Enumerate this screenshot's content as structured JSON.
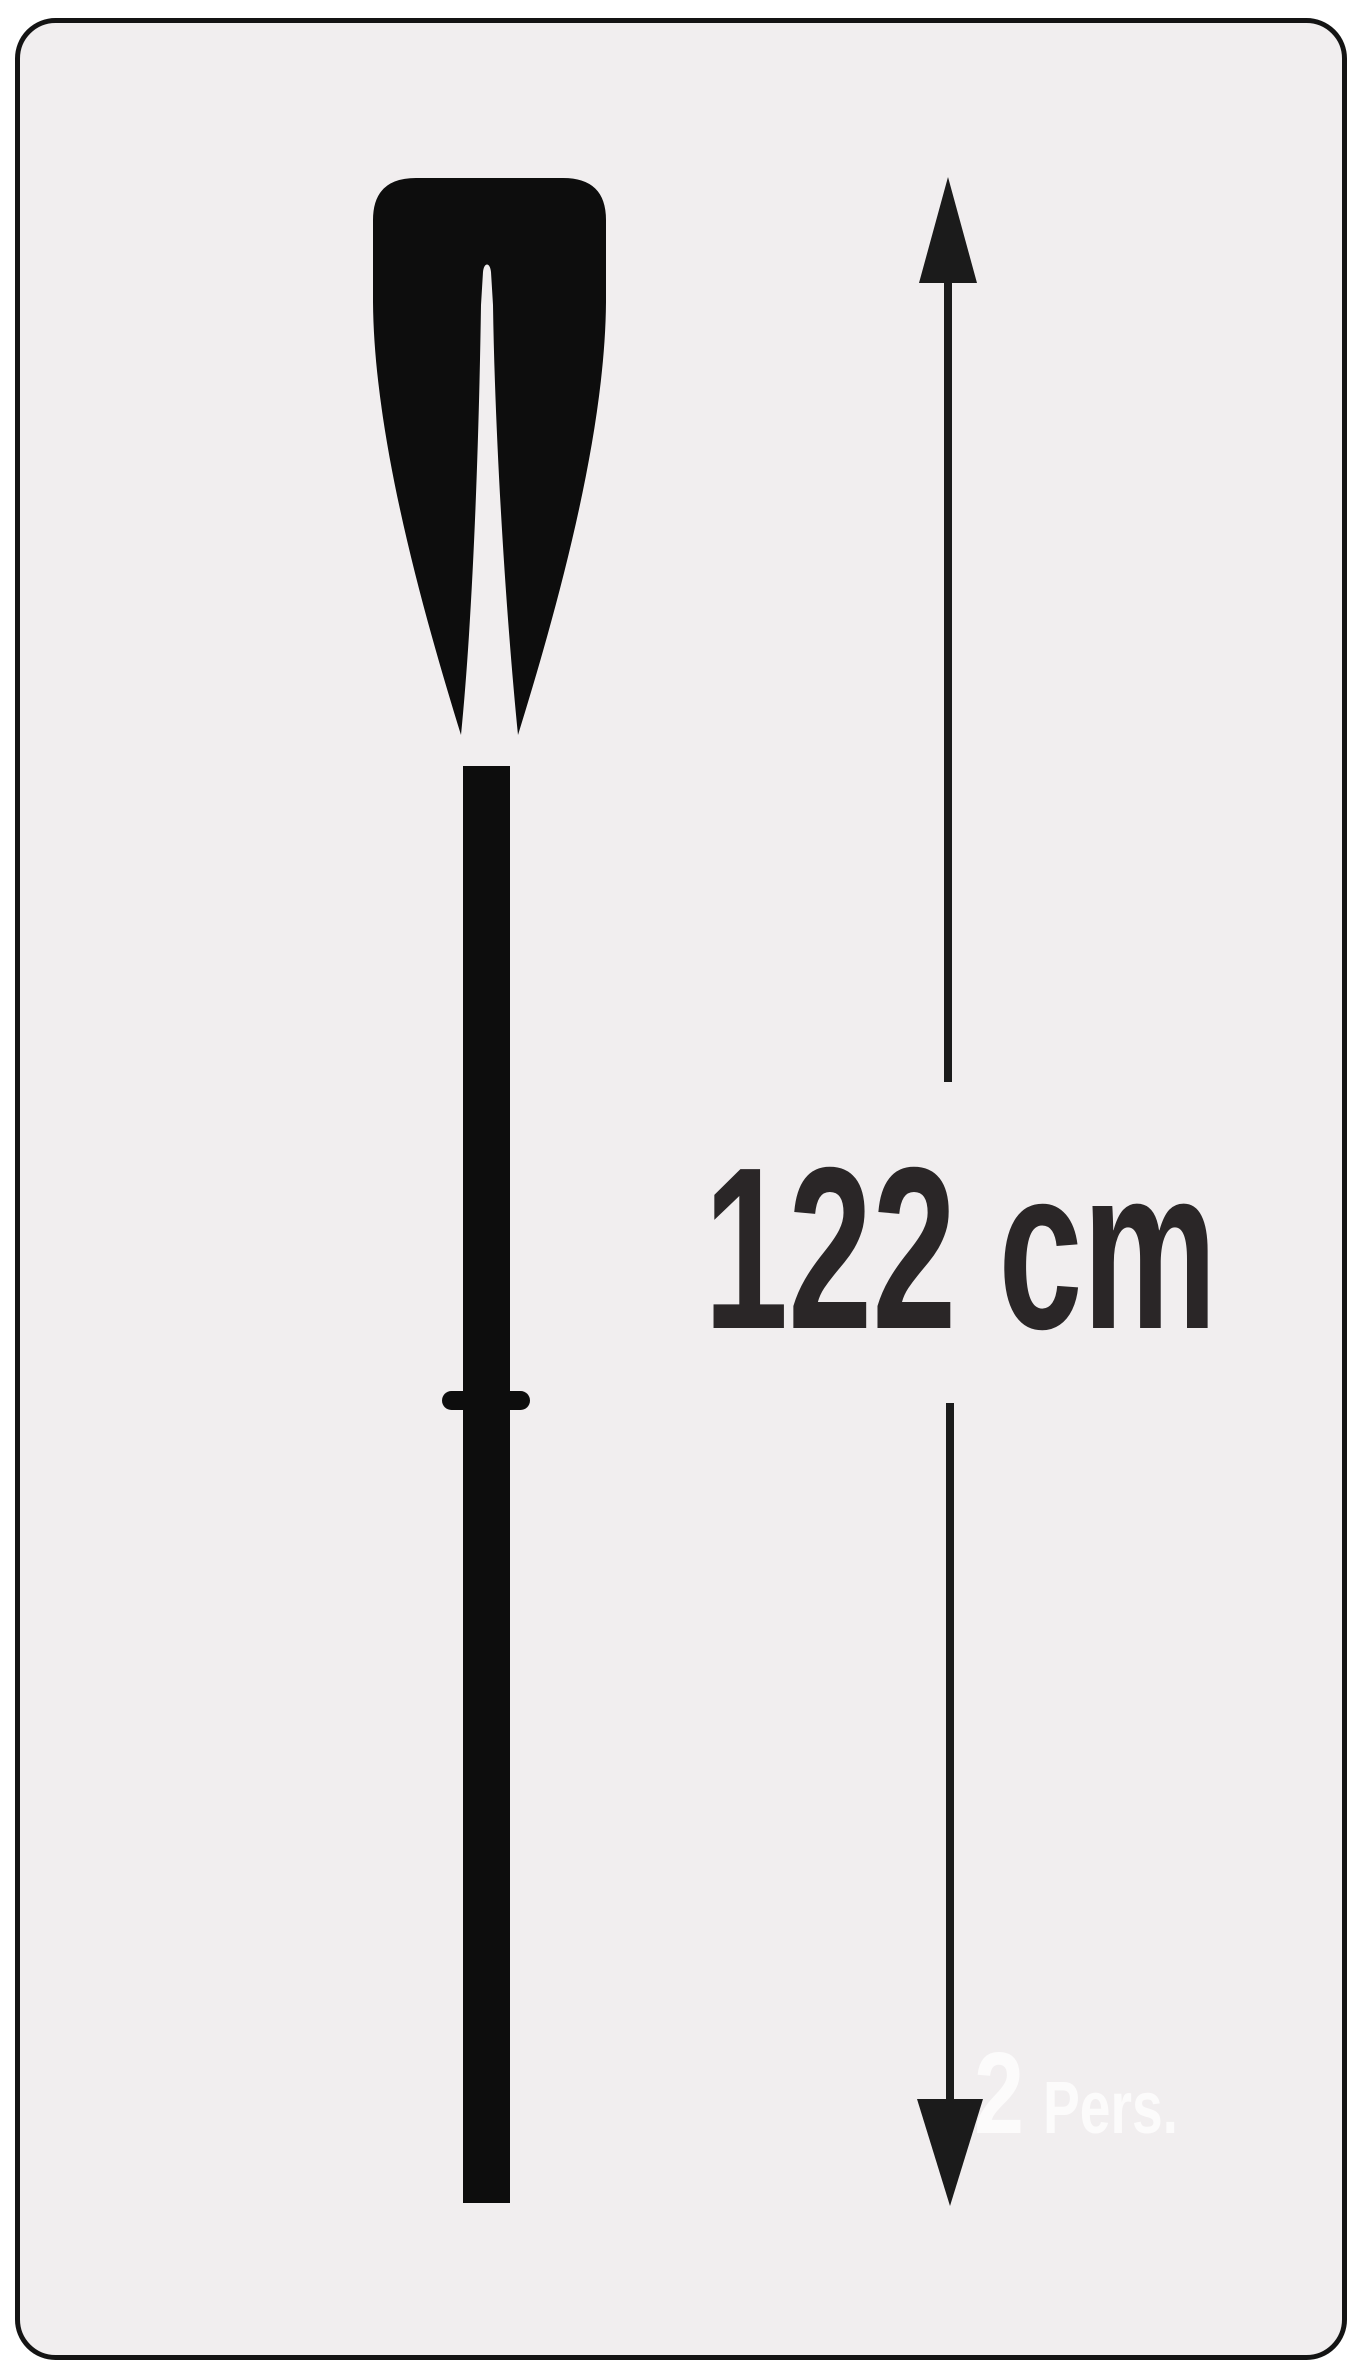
{
  "diagram": {
    "subject": "oar-paddle-length-diagram",
    "measurement": {
      "label": "122 cm",
      "value": "122",
      "unit": "cm"
    },
    "capacity": {
      "count": "2",
      "label": "Pers."
    },
    "colors": {
      "page_bg": "#ffffff",
      "panel_bg": "#f1eeef",
      "frame_stroke": "#141414",
      "ink": "#0d0d0d",
      "arrow_ink": "#1b1b1b",
      "measurement_text": "#2a2627",
      "capacity_text": "#fcfbfb"
    },
    "icons": [
      "paddle-icon",
      "measure-arrow-up-icon",
      "measure-arrow-down-icon"
    ]
  }
}
